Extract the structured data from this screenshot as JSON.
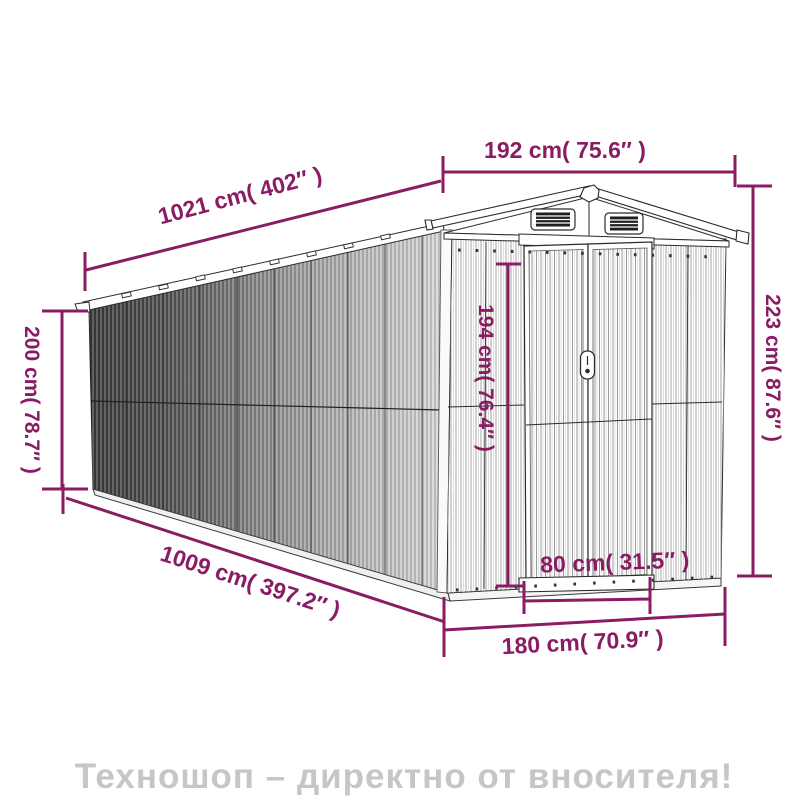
{
  "diagram": {
    "subject": "garden shed dimension drawing",
    "dimensions": {
      "front_width": "192 cm( 75.6″ )",
      "length_top": "1021 cm( 402″ )",
      "wall_height": "200 cm( 78.7″ )",
      "ridge_height": "223 cm( 87.6″ )",
      "door_height": "194 cm( 76.4″ )",
      "length_bottom": "1009 cm( 397.2″ )",
      "door_width": "80 cm( 31.5″ )",
      "front_base_width": "180 cm( 70.9″ )"
    },
    "colors": {
      "dimension_accent": "#8a1c63",
      "line_art": "#2b2b2b",
      "wall_dark": "#3e3e3e",
      "wall_light": "#d6d6d6",
      "watermark_gray": "#c6c6c6"
    }
  },
  "watermark": {
    "text": "Техношоп – директно от вносителя!"
  }
}
